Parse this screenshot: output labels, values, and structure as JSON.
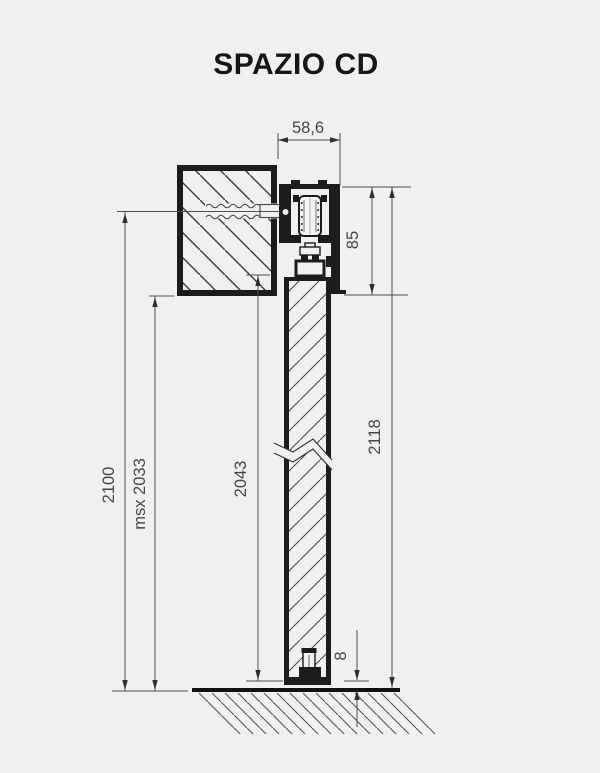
{
  "title": "SPAZIO CD",
  "dimensions": {
    "track_width": "58,6",
    "header_height": "85",
    "overall_height": "2118",
    "door_leaf_height": "2043",
    "wall_opening_height": "2100",
    "max_door_height": "msx  2033",
    "floor_clearance": "8"
  },
  "colors": {
    "background": "#f0f0f1",
    "ink": "#1c1c1c",
    "dimension": "#464646"
  }
}
